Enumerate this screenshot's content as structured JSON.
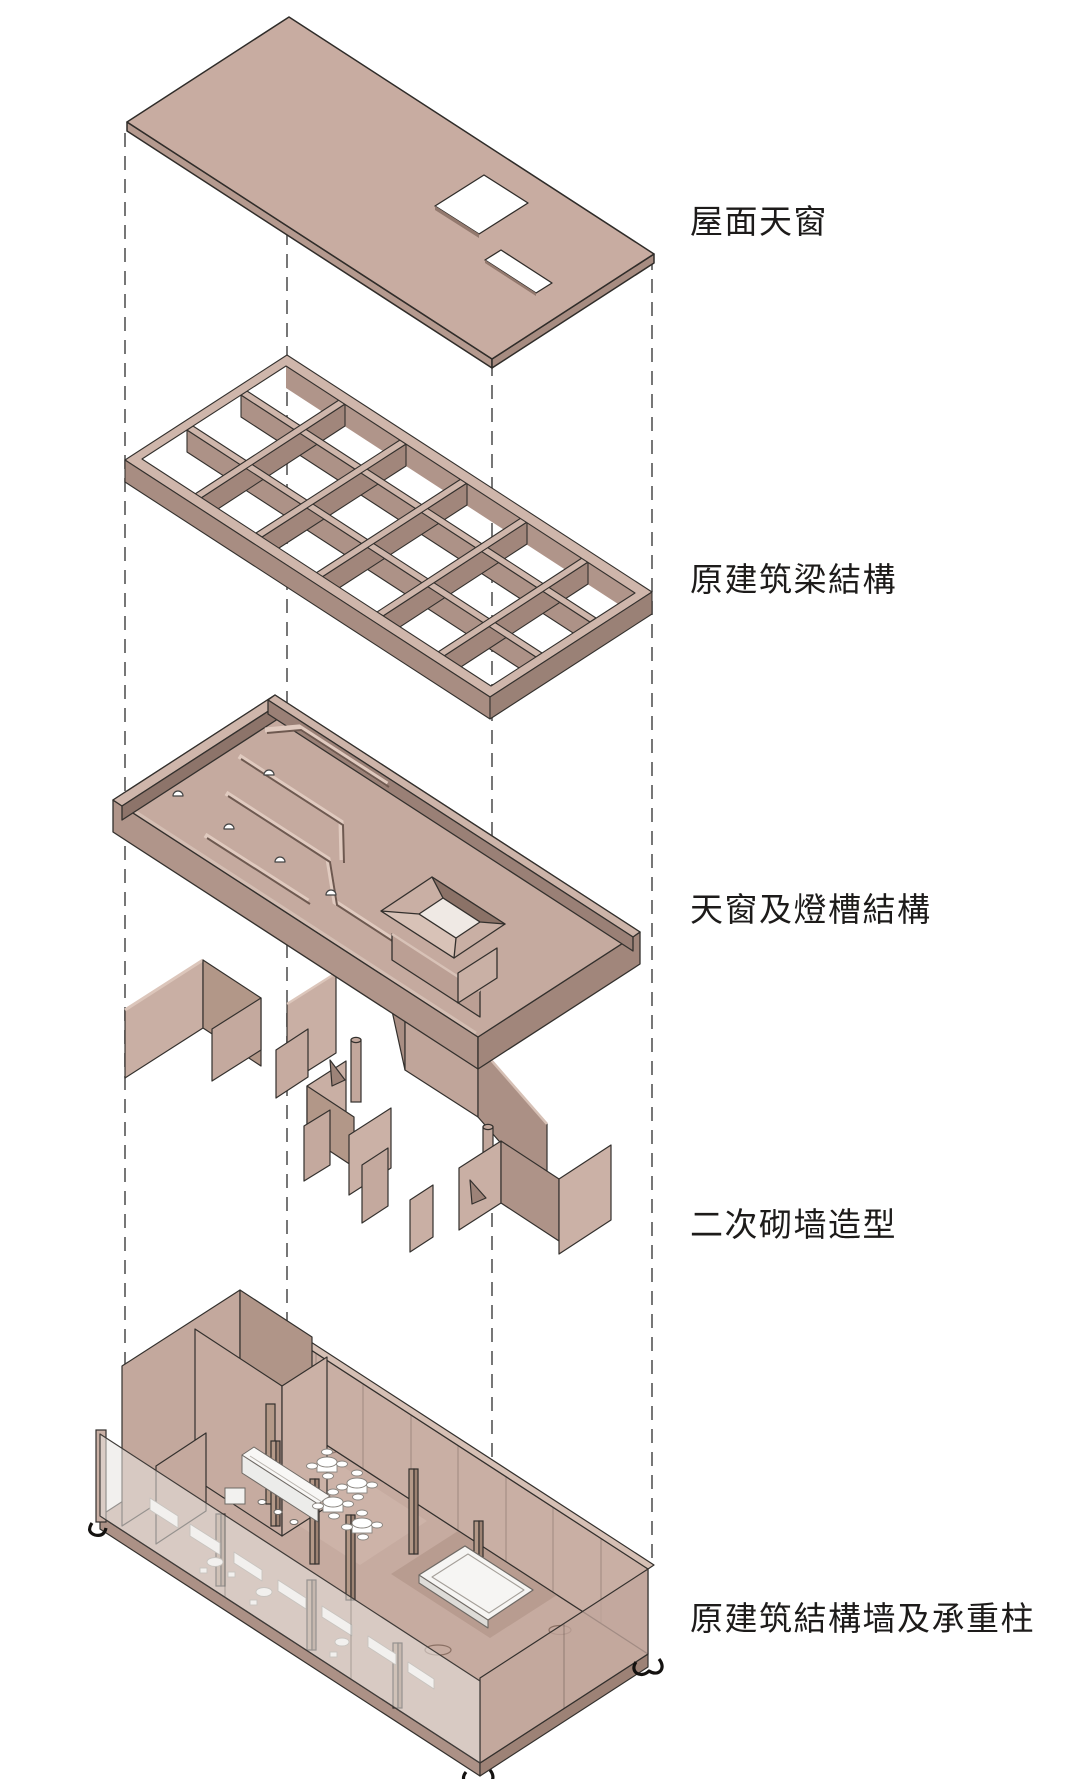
{
  "page": {
    "background": "#ffffff",
    "width": 1080,
    "height": 1779
  },
  "diagram": {
    "type": "exploded-axonometric-architecture-diagram",
    "projection_guide_lines": 4,
    "layers": [
      {
        "id": "roof-skylight",
        "label": "屋面天窗"
      },
      {
        "id": "original-beam-structure",
        "label": "原建筑梁結構"
      },
      {
        "id": "skylight-light-trough",
        "label": "天窗及燈槽結構"
      },
      {
        "id": "secondary-masonry-walls",
        "label": "二次砌墙造型"
      },
      {
        "id": "original-walls-columns",
        "label": "原建筑結構墙及承重柱"
      }
    ],
    "colors": {
      "surface": "#c6aba0",
      "surface_light": "#cfb6ab",
      "surface_mid": "#b59a8f",
      "surface_shadow": "#ab9085",
      "surface_dark": "#8d746a",
      "outline": "#33302d",
      "guide_line": "#555555",
      "glass": "#e7e4e0",
      "furniture": "#ffffff",
      "label_text": "#1d1b1a",
      "background": "#ffffff"
    }
  }
}
